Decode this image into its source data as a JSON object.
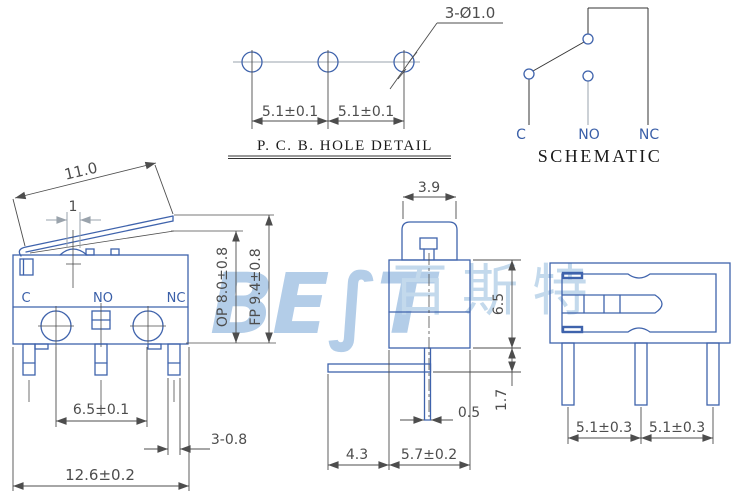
{
  "colors": {
    "part_outline": "#3f63ac",
    "dimension": "#4d4d4d",
    "terminal_label": "#3a5fa8",
    "centerline_gray": "#9aa3ac",
    "title_text": "#1a1a1a",
    "watermark_logo": "#b3cde8",
    "watermark_cjk": "#c3d9ec"
  },
  "watermark": {
    "logo": "BE∫T",
    "cjk": "百斯特"
  },
  "pcb_detail": {
    "title": "P. C. B.  HOLE DETAIL",
    "hole_callout": "3-Ø1.0",
    "pitch_left": "5.1±0.1",
    "pitch_right": "5.1±0.1"
  },
  "schematic": {
    "title": "SCHEMATIC",
    "terminal_common": "C",
    "terminal_no": "NO",
    "terminal_nc": "NC"
  },
  "side_view": {
    "terminal_common": "C",
    "terminal_no": "NO",
    "terminal_nc": "NC",
    "lever_length": "11.0",
    "plunger_width": "1",
    "op_height": "OP  8.0±0.8",
    "fp_height": "FP  9.4±0.8",
    "contact_pitch": "6.5±0.1",
    "pin_width": "3-0.8",
    "body_width": "12.6±0.2"
  },
  "front_view": {
    "lever_width": "3.9",
    "body_height": "6.5",
    "pin_thickness": "0.5",
    "bracket_drop": "1.7",
    "bracket_length": "4.3",
    "body_depth": "5.7±0.2"
  },
  "bottom_view": {
    "pin_pitch_left": "5.1±0.3",
    "pin_pitch_right": "5.1±0.3"
  }
}
